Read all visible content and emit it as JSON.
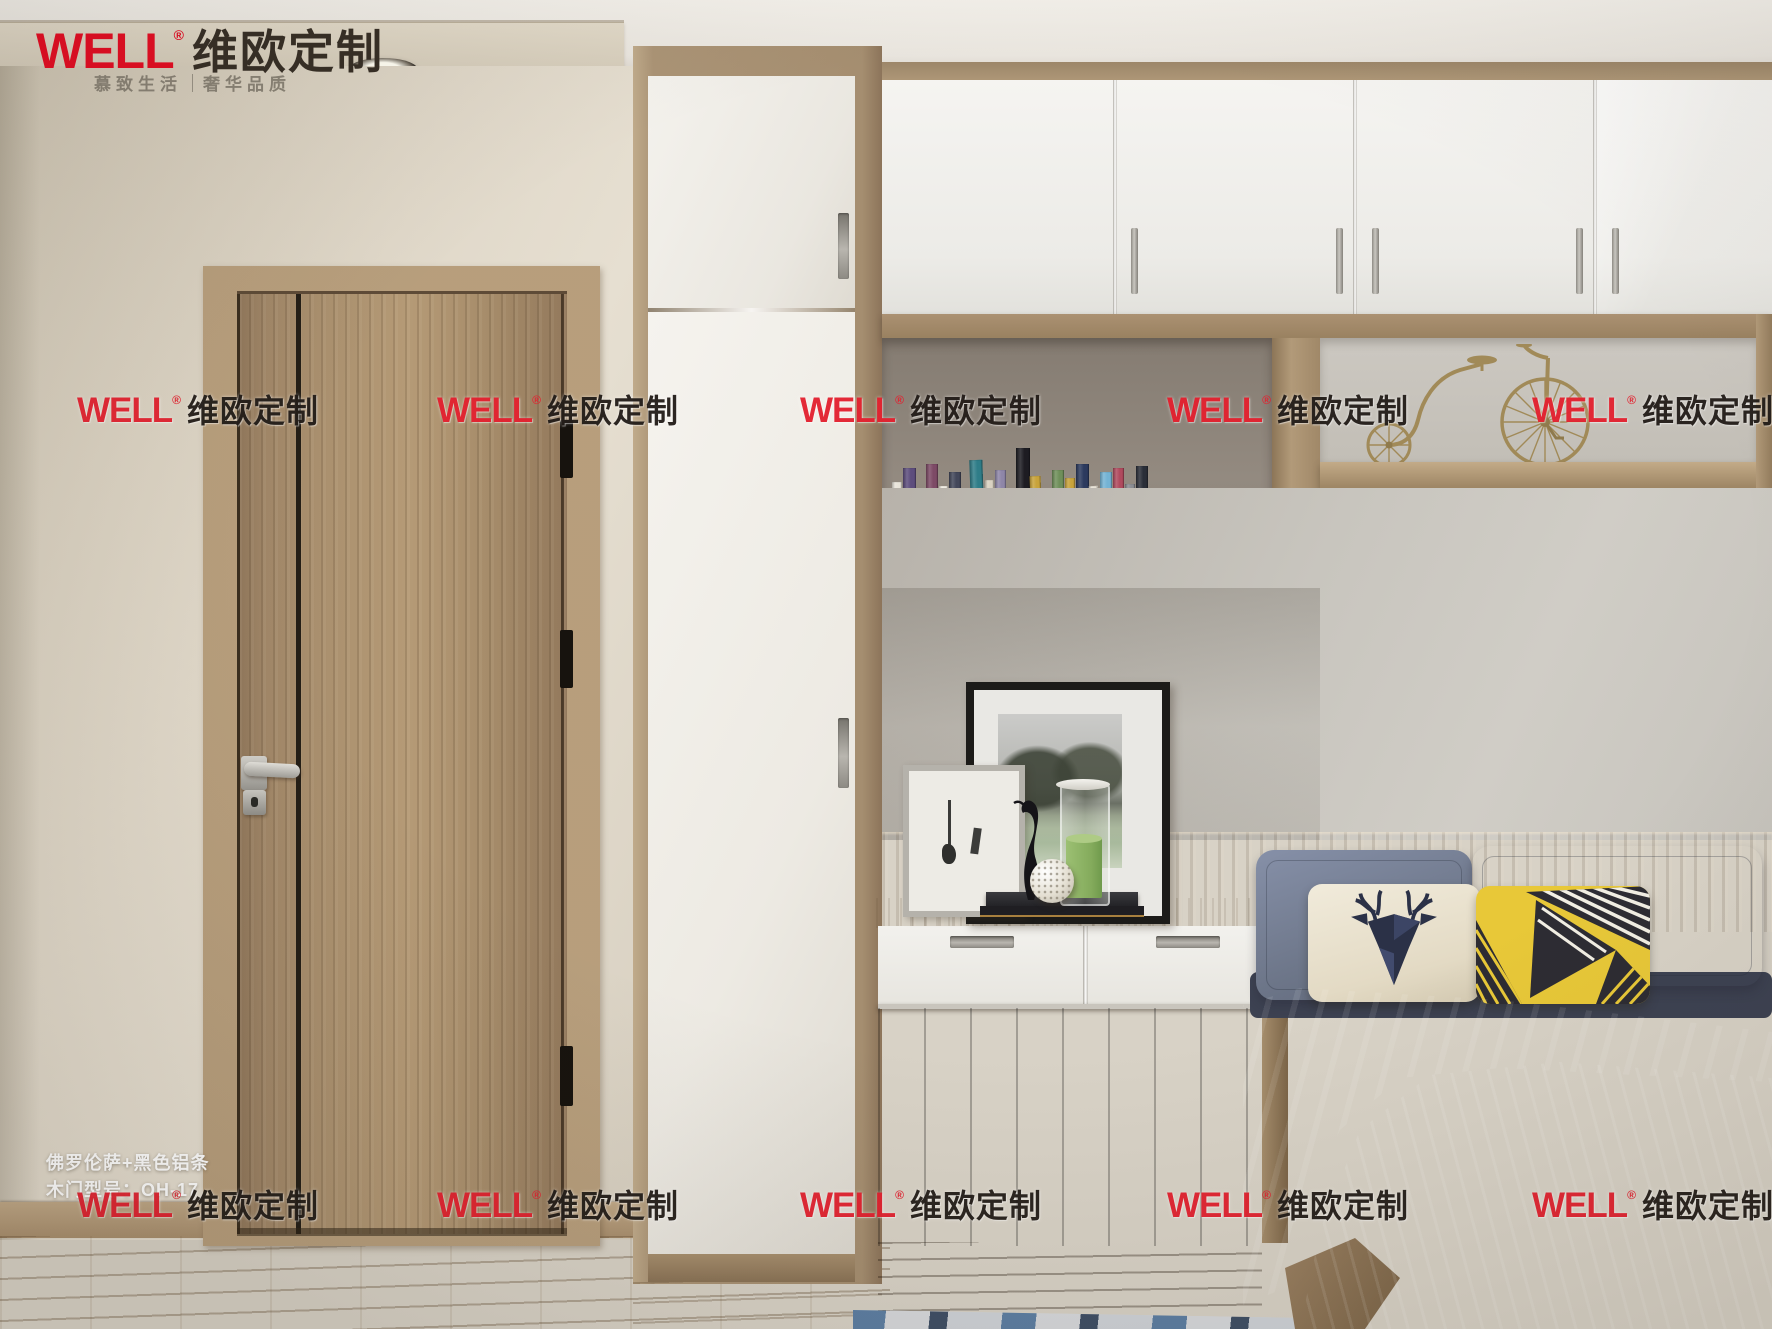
{
  "brand": {
    "name": "WELL",
    "registered": "®",
    "name_cn": "维欧定制",
    "tagline_left": "慕致生活",
    "tagline_right": "奢华品质",
    "logo_red": "#e60c23",
    "logo_dark": "#372f26"
  },
  "watermark": {
    "name": "WELL",
    "registered": "®",
    "name_cn": "维欧定制",
    "red": "#e32230",
    "black": "#241e1a",
    "rows": [
      {
        "y": 386,
        "xs": [
          77,
          437,
          800,
          1167,
          1532
        ]
      },
      {
        "y": 1181,
        "xs": [
          77,
          437,
          800,
          1167,
          1532
        ]
      }
    ]
  },
  "caption": {
    "line1": "佛罗伦萨+黑色铝条",
    "line2": "木门型号：OH-17"
  },
  "palette": {
    "ceiling": "#eeeae3",
    "soffit": "#d9d0bf",
    "wall_left": "#ddd5c6",
    "wall_right": "#c9c6bf",
    "door_wood": "#a98f6f",
    "door_frame_wood": "#b69d7c",
    "black_aluminum_strip": "#241e16",
    "wardrobe_white": "#f1efea",
    "cabinet_white": "#f3f2ef",
    "cabinet_wood_band": "#a28c6e",
    "shelf_back_dark": "#8a8177",
    "shelf_back_light": "#c9c5be",
    "bicycle_brass": "#a18a58",
    "headboard_wood": "#a8937a",
    "desk_wood": "#b8a281",
    "under_desk": "#3c3127",
    "floor_wood": "#c6b090",
    "pillow_gray": "#79829a",
    "pillow_cream": "#ece4d0",
    "pillow_deer_navy": "#2b3147",
    "pillow_yellow": "#e8c838",
    "blanket_teal": "#6f9c8e",
    "duvet_gray": "#979aa9",
    "candle_green": "#8fb868"
  },
  "books": [
    {
      "c": "#e9e4da",
      "h": 78,
      "w": 10
    },
    {
      "c": "#5d4d7d",
      "h": 92,
      "w": 13
    },
    {
      "c": "#ded8ca",
      "h": 70,
      "w": 8
    },
    {
      "c": "#7d4a66",
      "h": 96,
      "w": 12
    },
    {
      "c": "#f0ece2",
      "h": 74,
      "w": 9
    },
    {
      "c": "#43475a",
      "h": 88,
      "w": 12
    },
    {
      "c": "#e6e0d4",
      "h": 70,
      "w": 8
    },
    {
      "c": "#2f7d88",
      "h": 100,
      "w": 13
    },
    {
      "c": "#d9d2c2",
      "h": 80,
      "w": 9
    },
    {
      "c": "#8e86a8",
      "h": 90,
      "w": 11
    },
    {
      "c": "#f1ede5",
      "h": 72,
      "w": 8
    },
    {
      "c": "#1d1c22",
      "h": 112,
      "w": 14
    },
    {
      "c": "#c8a33b",
      "h": 84,
      "w": 11
    },
    {
      "c": "#efe9dd",
      "h": 70,
      "w": 8
    },
    {
      "c": "#6f8f5a",
      "h": 90,
      "w": 12
    },
    {
      "c": "#c8a33b",
      "h": 82,
      "w": 10
    },
    {
      "c": "#2c3a5e",
      "h": 96,
      "w": 13
    },
    {
      "c": "#e8e2d6",
      "h": 74,
      "w": 9
    },
    {
      "c": "#74b3d4",
      "h": 88,
      "w": 12
    },
    {
      "c": "#b04a5e",
      "h": 92,
      "w": 11
    },
    {
      "c": "#8b8d93",
      "h": 76,
      "w": 10
    },
    {
      "c": "#2a2e38",
      "h": 94,
      "w": 12
    }
  ]
}
